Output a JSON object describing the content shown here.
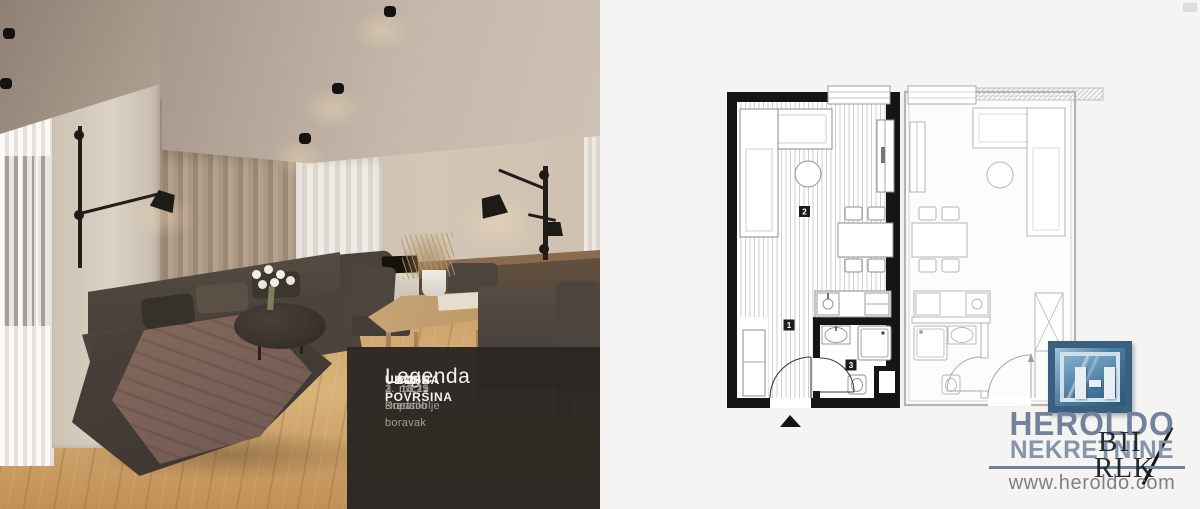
{
  "legend": {
    "title": "Legenda",
    "items": [
      {
        "name": "1. Predsoblje",
        "value": "3,25",
        "unit": "m2"
      },
      {
        "name": "2. Dnevni boravak",
        "value": "18,11",
        "unit": "m2"
      },
      {
        "name": "3. Kupatilo",
        "value": "3,19",
        "unit": "m2"
      }
    ],
    "total_label": "UKUPNA POVRŠINA",
    "total_value": "24,55",
    "total_unit": "m2"
  },
  "floor_plan": {
    "markers": [
      "1",
      "2",
      "3"
    ]
  },
  "branding": {
    "company": "HEROLDO",
    "tagline": "NEKRETNINE",
    "website": "www.heroldo.com",
    "watermark_top": "BII",
    "watermark_bottom": "RLK",
    "accent_color": "#6f8196",
    "logo_blue": "#3b5f7f"
  }
}
